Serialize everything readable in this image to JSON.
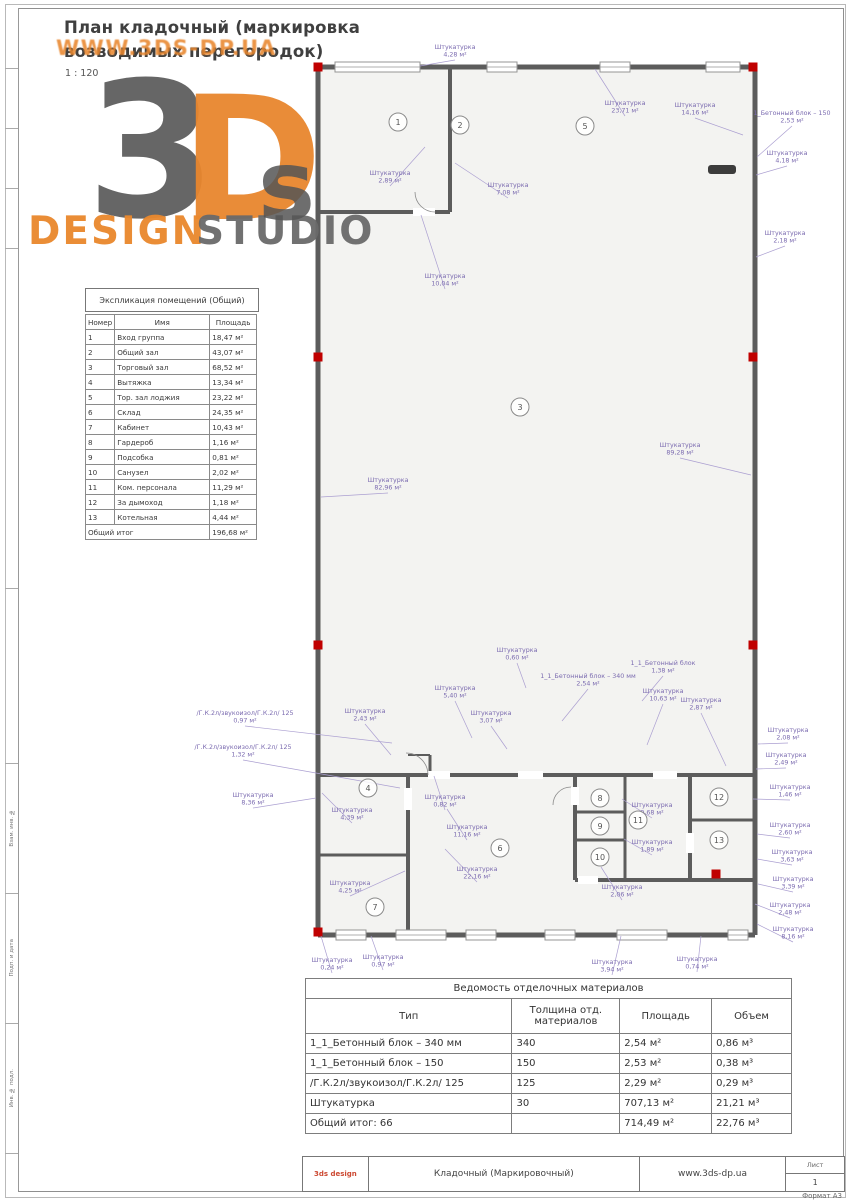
{
  "header": {
    "title_line1": "План кладочный (маркировка",
    "title_line2": "возводимых перегородок)",
    "scale": "1 : 120"
  },
  "watermark": {
    "url_text": "WWW.3DS-DP.UA",
    "big_3": "3",
    "big_d": "D",
    "big_s": "s",
    "design": "DESIGN",
    "studio": "STUDIO"
  },
  "explication": {
    "title": "Экспликация помещений (Общий)",
    "columns": [
      "Номер",
      "Имя",
      "Площадь"
    ],
    "rows": [
      [
        "1",
        "Вход группа",
        "18,47 м²"
      ],
      [
        "2",
        "Общий зал",
        "43,07 м²"
      ],
      [
        "3",
        "Торговый зал",
        "68,52 м²"
      ],
      [
        "4",
        "Вытяжка",
        "13,34 м²"
      ],
      [
        "5",
        "Тор. зал лоджия",
        "23,22 м²"
      ],
      [
        "6",
        "Склад",
        "24,35 м²"
      ],
      [
        "7",
        "Кабинет",
        "10,43 м²"
      ],
      [
        "8",
        "Гардероб",
        "1,16 м²"
      ],
      [
        "9",
        "Подсобка",
        "0,81 м²"
      ],
      [
        "10",
        "Санузел",
        "2,02 м²"
      ],
      [
        "11",
        "Ком. персонала",
        "11,29 м²"
      ],
      [
        "12",
        "За дымоход",
        "1,18 м²"
      ],
      [
        "13",
        "Котельная",
        "4,44 м²"
      ]
    ],
    "total_label": "Общий итог",
    "total_value": "196,68 м²"
  },
  "materials": {
    "title": "Ведомость отделочных материалов",
    "columns": [
      "Тип",
      "Толщина отд. материалов",
      "Площадь",
      "Объем"
    ],
    "rows": [
      [
        "1_1_Бетонный блок – 340 мм",
        "340",
        "2,54 м²",
        "0,86 м³"
      ],
      [
        "1_1_Бетонный блок – 150",
        "150",
        "2,53 м²",
        "0,38 м³"
      ],
      [
        "/Г.К.2л/звукоизол/Г.К.2л/ 125",
        "125",
        "2,29 м²",
        "0,29 м³"
      ],
      [
        "Штукатурка",
        "30",
        "707,13 м²",
        "21,21 м³"
      ]
    ],
    "total_row": [
      "Общий итог: 66",
      "",
      "714,49 м²",
      "22,76 м³"
    ]
  },
  "titleblock": {
    "brand": "3ds design",
    "doc": "Кладочный (Маркировочный)",
    "site": "www.3ds-dp.ua",
    "sheet_label": "Лист",
    "sheet_number": "1",
    "format": "Формат А3"
  },
  "frame": {
    "stamp_cells": [
      "Взам. инв. №",
      "Подп. и дата",
      "Инв. № подл."
    ]
  },
  "plan": {
    "wall_color": "#5c5c5c",
    "marker_color": "#c00000",
    "annotation_color": "#7b6bb0",
    "leader_color": "#ab9fd1",
    "floor_fill": "#f3f3f1",
    "walls": [
      [
        23,
        32,
        460,
        32,
        5
      ],
      [
        460,
        32,
        460,
        900,
        5
      ],
      [
        23,
        900,
        460,
        900,
        5
      ],
      [
        23,
        32,
        23,
        900,
        5
      ],
      [
        155,
        32,
        155,
        177,
        4
      ],
      [
        23,
        177,
        155,
        177,
        4
      ],
      [
        23,
        740,
        460,
        740,
        4
      ],
      [
        113,
        740,
        113,
        900,
        4
      ],
      [
        23,
        820,
        113,
        820,
        3
      ],
      [
        280,
        740,
        280,
        845,
        4
      ],
      [
        330,
        740,
        330,
        845,
        3
      ],
      [
        280,
        777,
        330,
        777,
        3
      ],
      [
        280,
        805,
        330,
        805,
        3
      ],
      [
        395,
        740,
        395,
        845,
        4
      ],
      [
        395,
        785,
        460,
        785,
        3
      ],
      [
        280,
        845,
        460,
        845,
        4
      ],
      [
        113,
        720,
        135,
        720,
        2
      ],
      [
        135,
        720,
        135,
        740,
        3
      ]
    ],
    "door_gaps": [
      [
        133,
        736,
        22,
        8
      ],
      [
        223,
        736,
        25,
        8
      ],
      [
        358,
        736,
        24,
        8
      ],
      [
        109,
        753,
        8,
        22
      ],
      [
        118,
        173,
        22,
        8
      ],
      [
        276,
        752,
        8,
        18
      ],
      [
        391,
        798,
        8,
        20
      ],
      [
        283,
        841,
        20,
        8
      ]
    ],
    "door_arcs": [
      "M133,740 A22,22 0 0 0 111,718",
      "M140,177 A20,20 0 0 1 120,157",
      "M276,752 A18,18 0 0 0 258,770"
    ],
    "windows_top": [
      [
        40,
        85
      ],
      [
        192,
        30
      ],
      [
        305,
        30
      ],
      [
        411,
        34
      ]
    ],
    "windows_bottom": [
      [
        41,
        30
      ],
      [
        101,
        50
      ],
      [
        171,
        30
      ],
      [
        250,
        30
      ],
      [
        322,
        50
      ],
      [
        433,
        20
      ]
    ],
    "markers": [
      [
        23,
        32
      ],
      [
        458,
        32
      ],
      [
        23,
        322
      ],
      [
        458,
        322
      ],
      [
        23,
        610
      ],
      [
        458,
        610
      ],
      [
        23,
        897
      ],
      [
        421,
        839
      ]
    ],
    "radiators": [
      [
        413,
        130,
        28,
        9
      ]
    ],
    "rooms": [
      {
        "n": "1",
        "x": 103,
        "y": 87
      },
      {
        "n": "2",
        "x": 165,
        "y": 90
      },
      {
        "n": "5",
        "x": 290,
        "y": 91
      },
      {
        "n": "3",
        "x": 225,
        "y": 372
      },
      {
        "n": "4",
        "x": 73,
        "y": 753
      },
      {
        "n": "6",
        "x": 205,
        "y": 813
      },
      {
        "n": "7",
        "x": 80,
        "y": 872
      },
      {
        "n": "8",
        "x": 305,
        "y": 763
      },
      {
        "n": "9",
        "x": 305,
        "y": 791
      },
      {
        "n": "10",
        "x": 305,
        "y": 822
      },
      {
        "n": "11",
        "x": 343,
        "y": 785
      },
      {
        "n": "12",
        "x": 424,
        "y": 762
      },
      {
        "n": "13",
        "x": 424,
        "y": 805
      }
    ],
    "annotations": [
      {
        "t": "Штукатурка",
        "v": "4,28 м²",
        "x": 160,
        "y": 14,
        "ex": 125,
        "ey": 31
      },
      {
        "t": "Штукатурка",
        "v": "23,71 м²",
        "x": 330,
        "y": 70,
        "ex": 300,
        "ey": 34
      },
      {
        "t": "Штукатурка",
        "v": "14,16 м²",
        "x": 400,
        "y": 72,
        "ex": 448,
        "ey": 100
      },
      {
        "t": "1_Бетонный блок – 150",
        "v": "2,53 м²",
        "x": 497,
        "y": 80,
        "ex": 462,
        "ey": 122
      },
      {
        "t": "Штукатурка",
        "v": "4,18 м²",
        "x": 492,
        "y": 120,
        "ex": 461,
        "ey": 140
      },
      {
        "t": "Штукатурка",
        "v": "2,18 м²",
        "x": 490,
        "y": 200,
        "ex": 461,
        "ey": 222
      },
      {
        "t": "Штукатурка",
        "v": "2,89 м²",
        "x": 95,
        "y": 140,
        "ex": 130,
        "ey": 112
      },
      {
        "t": "Штукатурка",
        "v": "7,08 м²",
        "x": 213,
        "y": 152,
        "ex": 160,
        "ey": 128
      },
      {
        "t": "Штукатурка",
        "v": "10,04 м²",
        "x": 150,
        "y": 243,
        "ex": 126,
        "ey": 180
      },
      {
        "t": "Штукатурка",
        "v": "82,96 м²",
        "x": 93,
        "y": 447,
        "ex": 26,
        "ey": 462
      },
      {
        "t": "Штукатурка",
        "v": "89,28 м²",
        "x": 385,
        "y": 412,
        "ex": 456,
        "ey": 440
      },
      {
        "t": "Штукатурка",
        "v": "0,60 м²",
        "x": 222,
        "y": 617,
        "ex": 231,
        "ey": 653
      },
      {
        "t": "1_1_Бетонный блок – 340 мм",
        "v": "2,54 м²",
        "x": 293,
        "y": 643,
        "ex": 267,
        "ey": 686
      },
      {
        "t": "1_1_Бетонный блок",
        "v": "1,38 м²",
        "x": 368,
        "y": 630,
        "ex": 347,
        "ey": 666
      },
      {
        "t": "Штукатурка",
        "v": "10,63 м²",
        "x": 368,
        "y": 658,
        "ex": 352,
        "ey": 710
      },
      {
        "t": "Штукатурка",
        "v": "5,40 м²",
        "x": 160,
        "y": 655,
        "ex": 177,
        "ey": 703
      },
      {
        "t": "Штукатурка",
        "v": "2,43 м²",
        "x": 70,
        "y": 678,
        "ex": 96,
        "ey": 720
      },
      {
        "t": "/Г.К.2л/звукоизол/Г.К.2л/ 125",
        "v": "0,97 м²",
        "x": -50,
        "y": 680,
        "ex": 97,
        "ey": 708
      },
      {
        "t": "/Г.К.2л/звукоизол/Г.К.2л/ 125",
        "v": "1,32 м²",
        "x": -52,
        "y": 714,
        "ex": 105,
        "ey": 753
      },
      {
        "t": "Штукатурка",
        "v": "8,36 м²",
        "x": -42,
        "y": 762,
        "ex": 21,
        "ey": 763
      },
      {
        "t": "Штукатурка",
        "v": "4,39 м²",
        "x": 57,
        "y": 777,
        "ex": 27,
        "ey": 758
      },
      {
        "t": "Штукатурка",
        "v": "0,82 м²",
        "x": 150,
        "y": 764,
        "ex": 139,
        "ey": 741
      },
      {
        "t": "Штукатурка",
        "v": "11,16 м²",
        "x": 172,
        "y": 794,
        "ex": 152,
        "ey": 774
      },
      {
        "t": "Штукатурка",
        "v": "22,16 м²",
        "x": 182,
        "y": 836,
        "ex": 150,
        "ey": 814
      },
      {
        "t": "Штукатурка",
        "v": "4,25 м²",
        "x": 55,
        "y": 850,
        "ex": 110,
        "ey": 836
      },
      {
        "t": "Штукатурка",
        "v": "3,07 м²",
        "x": 196,
        "y": 680,
        "ex": 212,
        "ey": 714
      },
      {
        "t": "Штукатурка",
        "v": "0,24 м²",
        "x": 37,
        "y": 927,
        "ex": 26,
        "ey": 901
      },
      {
        "t": "Штукатурка",
        "v": "0,97 м²",
        "x": 88,
        "y": 924,
        "ex": 76,
        "ey": 901
      },
      {
        "t": "Штукатурка",
        "v": "3,94 м²",
        "x": 317,
        "y": 929,
        "ex": 326,
        "ey": 901
      },
      {
        "t": "Штукатурка",
        "v": "0,74 м²",
        "x": 402,
        "y": 926,
        "ex": 406,
        "ey": 901
      },
      {
        "t": "Штукатурка",
        "v": "2,08 м²",
        "x": 493,
        "y": 697,
        "ex": 463,
        "ey": 709
      },
      {
        "t": "Штукатурка",
        "v": "2,49 м²",
        "x": 491,
        "y": 722,
        "ex": 461,
        "ey": 734
      },
      {
        "t": "Штукатурка",
        "v": "1,46 м²",
        "x": 495,
        "y": 754,
        "ex": 458,
        "ey": 764
      },
      {
        "t": "Штукатурка",
        "v": "2,60 м²",
        "x": 495,
        "y": 792,
        "ex": 462,
        "ey": 799
      },
      {
        "t": "Штукатурка",
        "v": "3,63 м²",
        "x": 497,
        "y": 819,
        "ex": 462,
        "ey": 824
      },
      {
        "t": "Штукатурка",
        "v": "3,39 м²",
        "x": 498,
        "y": 846,
        "ex": 463,
        "ey": 849
      },
      {
        "t": "Штукатурка",
        "v": "2,48 м²",
        "x": 495,
        "y": 872,
        "ex": 460,
        "ey": 869
      },
      {
        "t": "Штукатурка",
        "v": "8,16 м²",
        "x": 498,
        "y": 896,
        "ex": 462,
        "ey": 889
      },
      {
        "t": "Штукатурка",
        "v": "9,68 м²",
        "x": 357,
        "y": 772,
        "ex": 327,
        "ey": 764
      },
      {
        "t": "Штукатурка",
        "v": "1,89 м²",
        "x": 357,
        "y": 809,
        "ex": 329,
        "ey": 804
      },
      {
        "t": "Штукатурка",
        "v": "2,06 м²",
        "x": 327,
        "y": 854,
        "ex": 306,
        "ey": 832
      },
      {
        "t": "Штукатурка",
        "v": "2,87 м²",
        "x": 406,
        "y": 667,
        "ex": 431,
        "ey": 731
      }
    ]
  }
}
